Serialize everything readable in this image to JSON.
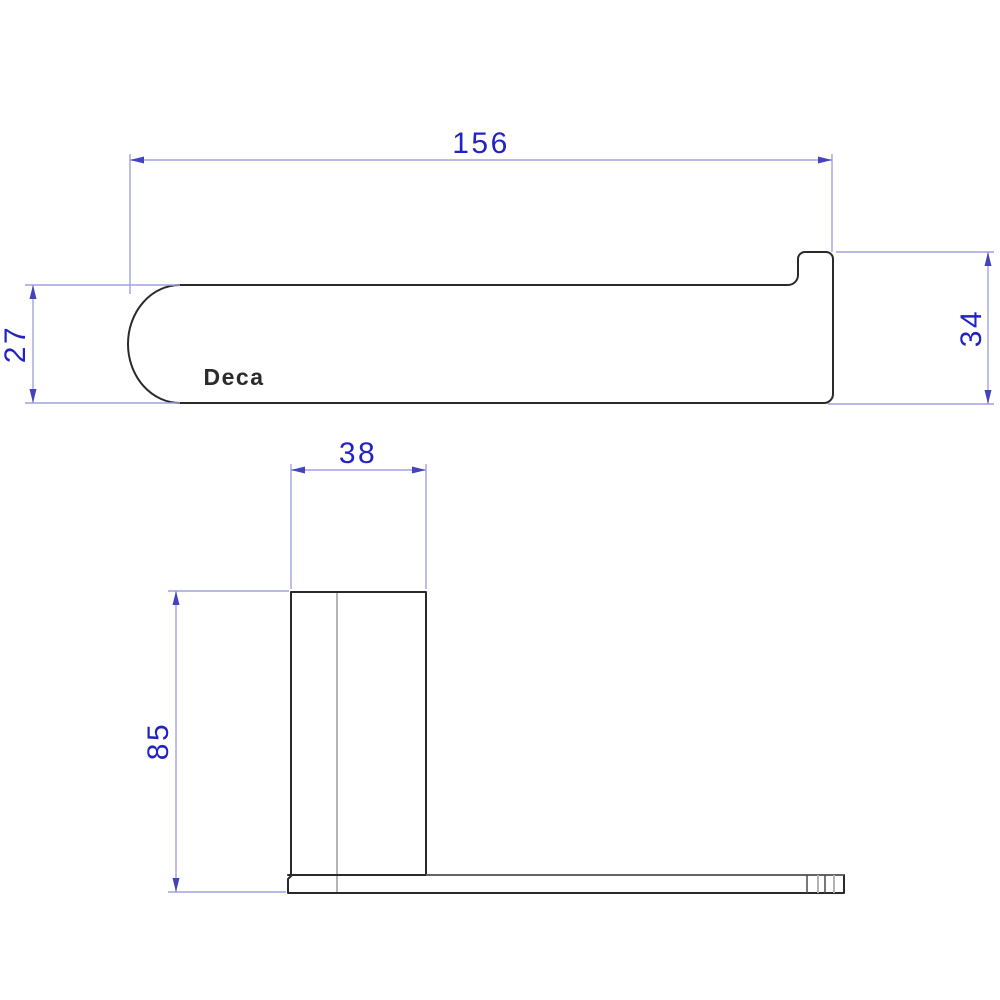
{
  "drawing": {
    "brand_label": "Deca",
    "dimensions": {
      "length": "156",
      "profile_height": "27",
      "end_height": "34",
      "post_width": "38",
      "post_height": "85"
    },
    "colors": {
      "background": "#ffffff",
      "outline": "#2a2a2a",
      "hidden_line": "#b4b4b4",
      "dimension_line": "#a2a2e0",
      "dimension_text": "#2323c3",
      "arrow": "#4343bd"
    }
  }
}
